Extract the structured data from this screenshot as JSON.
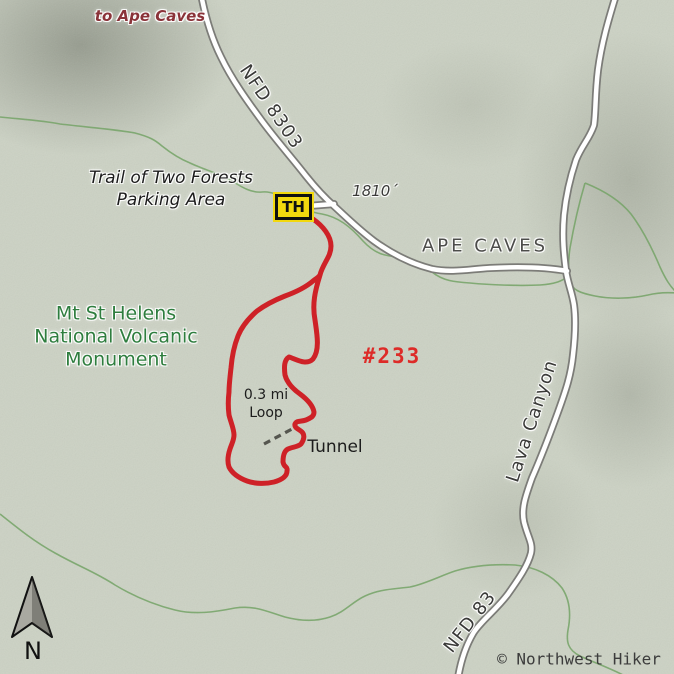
{
  "map": {
    "title": "Trail of Two Forests trail map",
    "labels": {
      "to_ape_caves": "to Ape Caves",
      "nfd_8303": "NFD 8303",
      "parking_line1": "Trail of Two Forests",
      "parking_line2": "Parking Area",
      "elevation": "1810´",
      "trailhead": "TH",
      "ape_caves": "APE CAVES",
      "monument_line1": "Mt St Helens",
      "monument_line2": "National Volcanic",
      "monument_line3": "Monument",
      "trail_number": "#233",
      "loop_line1": "0.3 mi",
      "loop_line2": "Loop",
      "tunnel": "Tunnel",
      "lava_canyon": "Lava Canyon",
      "nfd_83": "NFD 83",
      "compass_n": "N",
      "copyright": "© Northwest Hiker"
    },
    "colors": {
      "background": "#ccd2c4",
      "trail_red": "#ce2127",
      "trail_number_red": "#dd2b28",
      "monument_green": "#2e7d3e",
      "to_ape_caves_red": "#8a3339",
      "road_fill": "#ffffff",
      "road_casing": "#7c7c78",
      "green_trail": "#79a56b",
      "tunnel_dash_gray": "#55564f",
      "trailhead_yellow": "#f2d80e",
      "label_gray": "#3a3a38"
    }
  }
}
